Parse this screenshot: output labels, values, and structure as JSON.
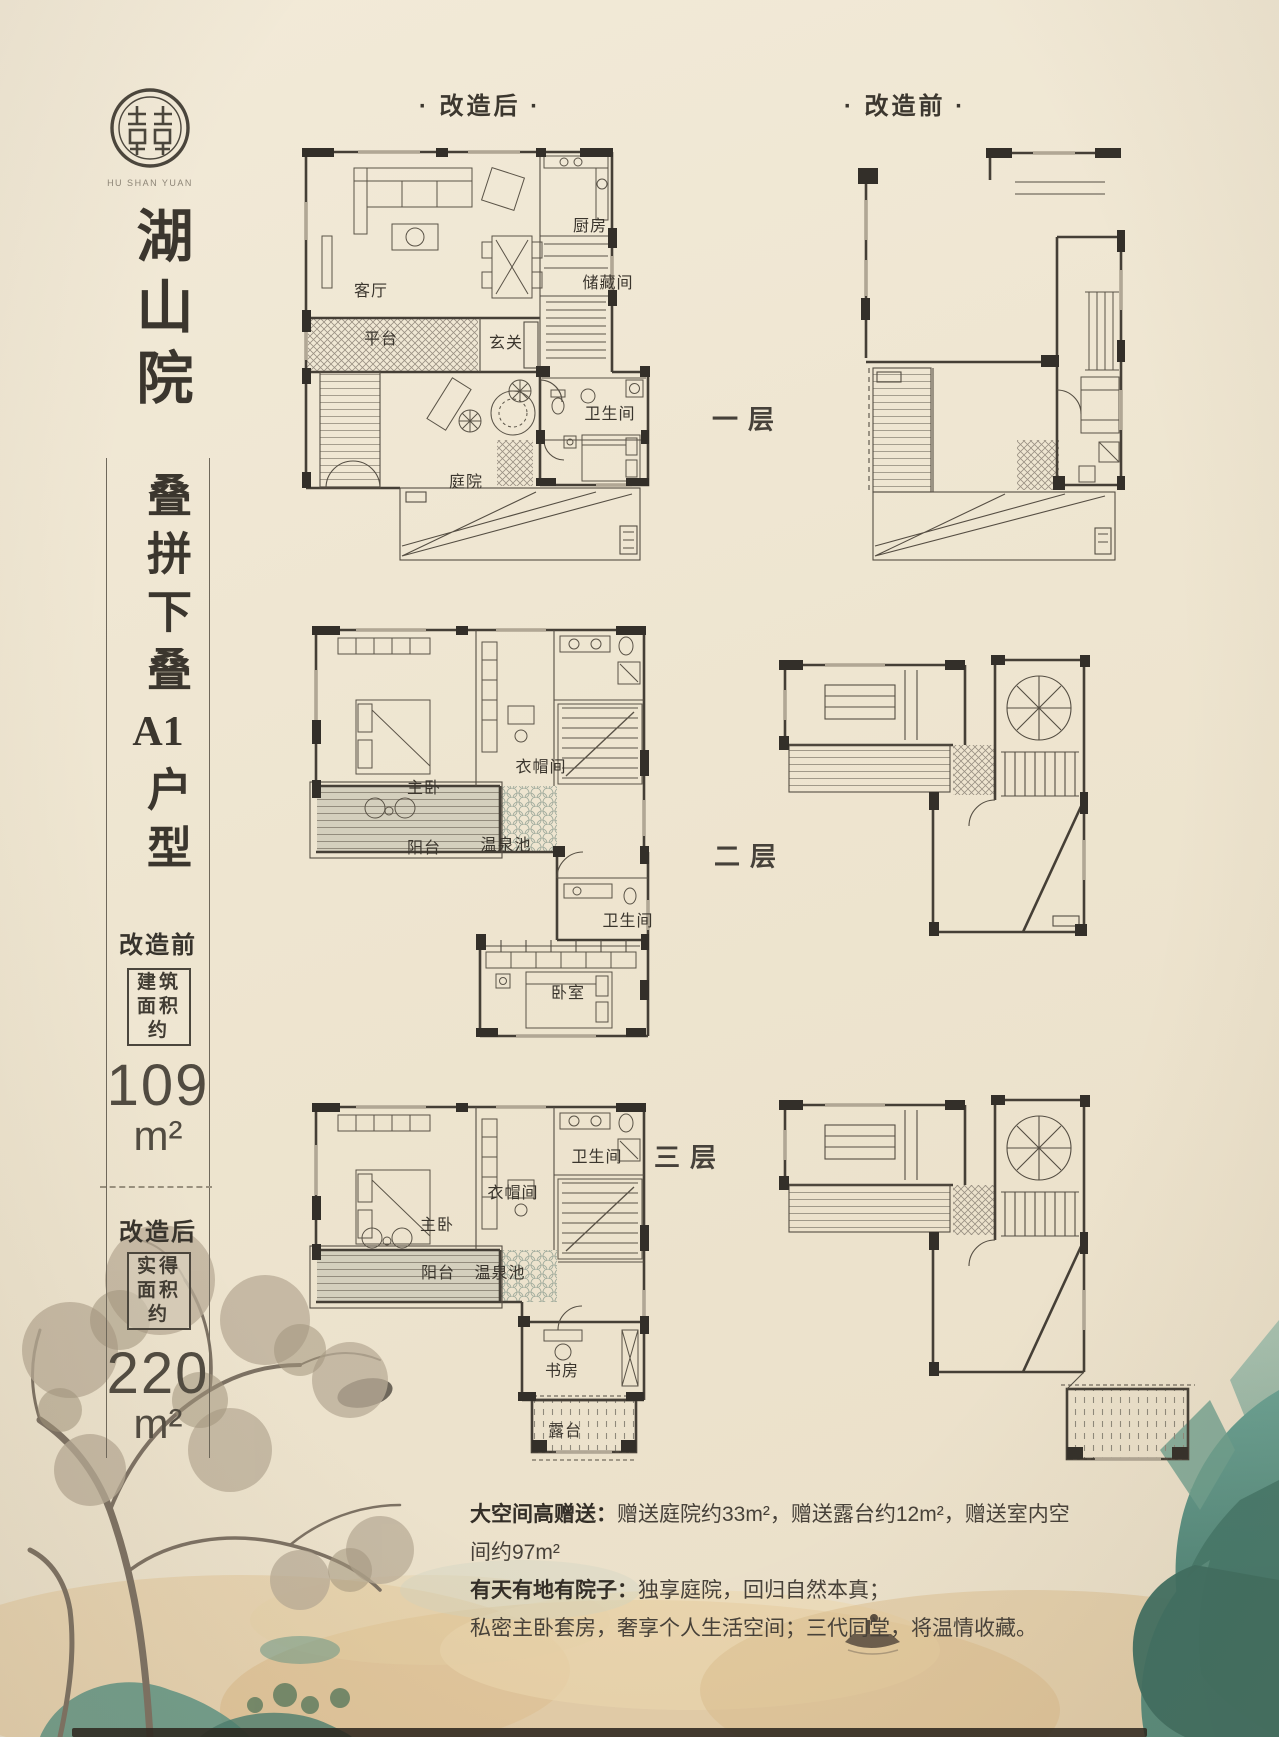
{
  "sidebar": {
    "logo_caption": "HU SHAN YUAN",
    "project_name": "湖山院",
    "product_type": "叠拼下叠",
    "unit_code": "A1",
    "unit_suffix": "户型",
    "before": {
      "label": "改造前",
      "area_box": [
        "建筑",
        "面积",
        "约"
      ],
      "value": "109",
      "unit": "m²"
    },
    "after": {
      "label": "改造后",
      "area_box": [
        "实得",
        "面积",
        "约"
      ],
      "value": "220",
      "unit": "m²"
    }
  },
  "headers": {
    "after": "· 改造后 ·",
    "before": "· 改造前 ·"
  },
  "floor_labels": [
    "一层",
    "二层",
    "三层"
  ],
  "rooms": {
    "f1": {
      "living": "客厅",
      "platform": "平台",
      "foyer": "玄关",
      "kitchen": "厨房",
      "storage": "储藏间",
      "bath": "卫生间",
      "courtyard": "庭院"
    },
    "f2": {
      "master": "主卧",
      "cloak": "衣帽间",
      "balcony": "阳台",
      "spring": "温泉池",
      "bath": "卫生间",
      "bedroom": "卧室"
    },
    "f3": {
      "master": "主卧",
      "cloak": "衣帽间",
      "bath": "卫生间",
      "balcony": "阳台",
      "spring": "温泉池",
      "study": "书房",
      "terrace": "露台"
    }
  },
  "footer": {
    "l1_label": "大空间高赠送：",
    "l1_text": "赠送庭院约33m²，赠送露台约12m²，赠送室内空间约97m²",
    "l2_label": "有天有地有院子：",
    "l2_text": "独享庭院，回归自然本真；",
    "l3_text": "私密主卧套房，奢享个人生活空间；三代同堂，将温情收藏。"
  },
  "colors": {
    "background": "#ece3cf",
    "ink": "#3e3a33",
    "plan_line": "#453f36",
    "teal": "#4e8578",
    "gold": "#d9b98a"
  }
}
